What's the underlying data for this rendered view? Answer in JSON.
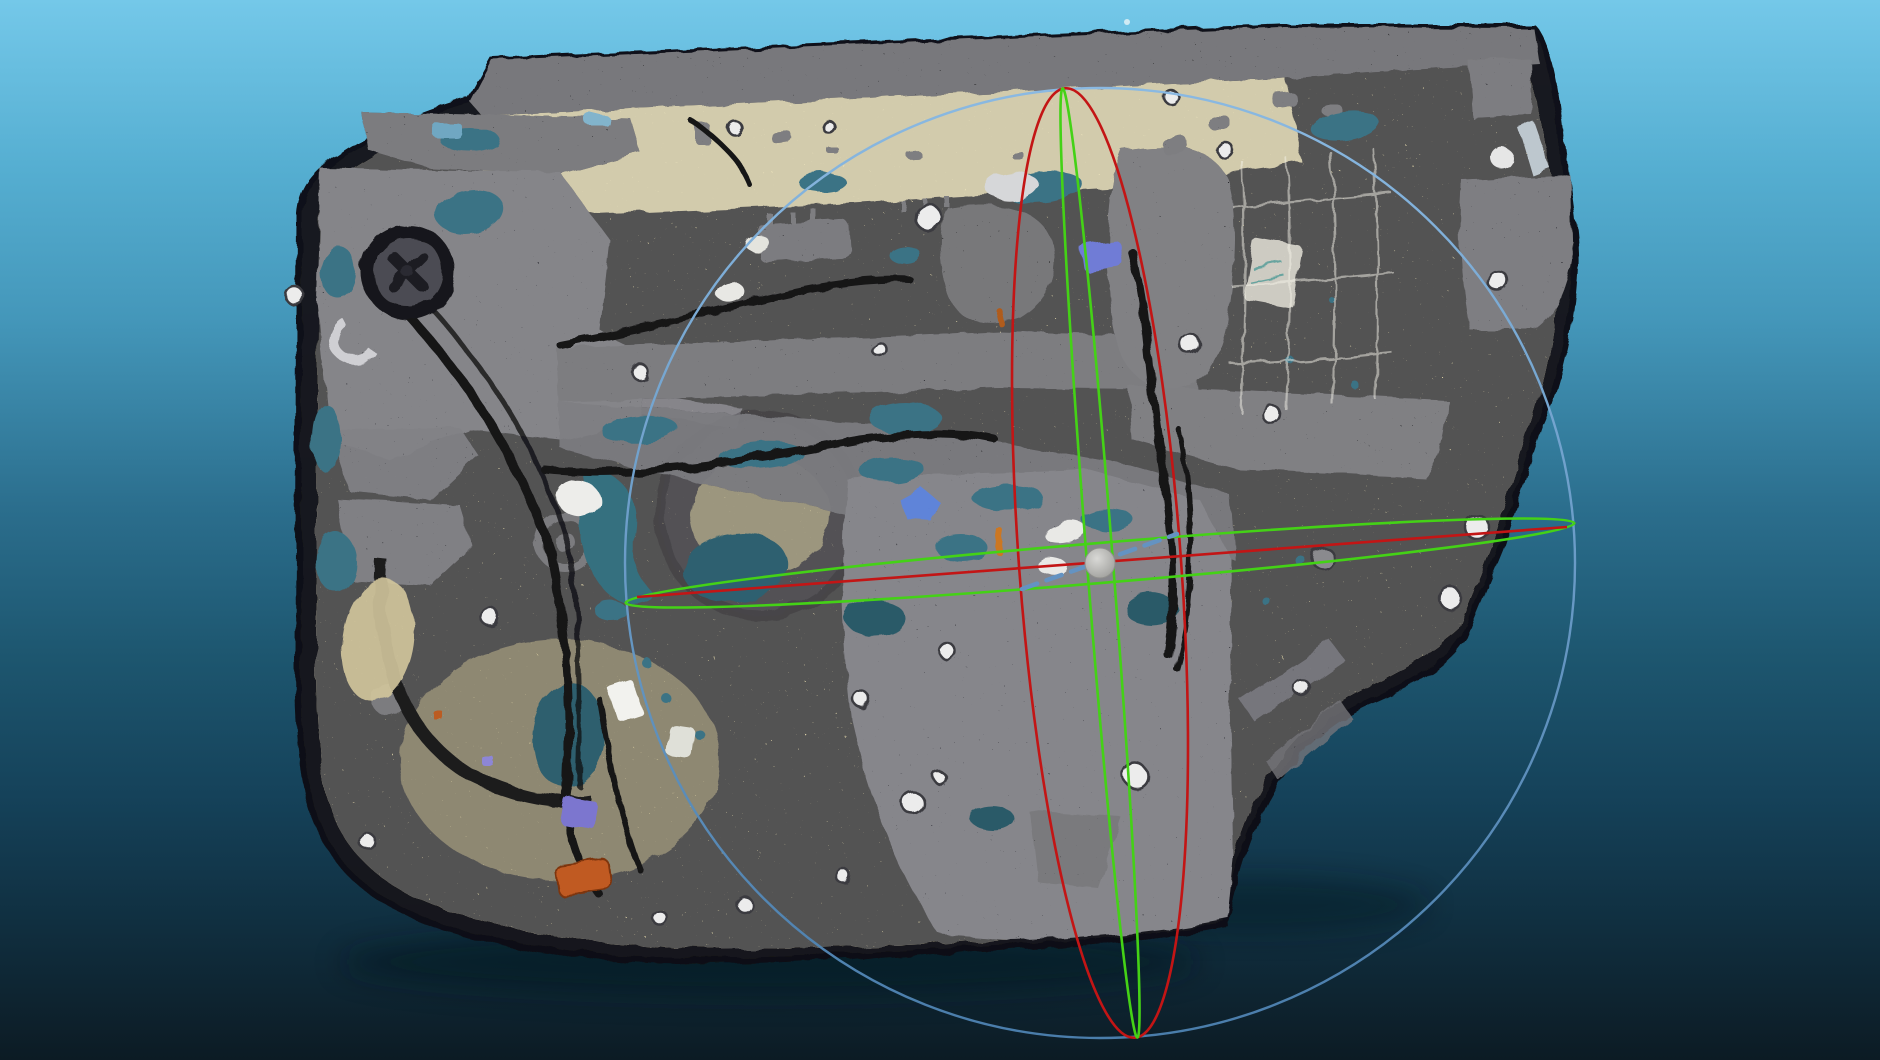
{
  "app": {
    "name": "3d-scan-viewer",
    "view": "point-cloud-viewport",
    "content": "scanned car door inner panel with rotation gizmo"
  },
  "background": {
    "top": "#74c8e9",
    "upper": "#4founds97ba",
    "mid": "#2b6e8d",
    "lower": "#15425a",
    "bottom": "#0c1b24"
  },
  "scan_object": {
    "label": "car-door-inner-panel-scan",
    "panel_tan": "#d7cda4",
    "cream_band": "#e9e0bc",
    "component_black": "#1e1e22",
    "metal_gray": "#2f2f35",
    "hole_teal": "#3a7385",
    "wire_black": "#131315",
    "highlight_white": "#ececec",
    "connector_violet": "#6f7bd6",
    "patch_blue": "#5d84dd",
    "rust_orange": "#c05a22"
  },
  "gizmo": {
    "center_x": 1100,
    "center_y": 563,
    "sphere": {
      "radius": 15,
      "color": "#b9b9b6",
      "edge_color": "#8f8f8c"
    },
    "outer_circle": {
      "r": 475,
      "width": 2.4,
      "color_top": "#8ab9e2",
      "color_bottom": "#4a7dab"
    },
    "red_ring": {
      "rx": 81,
      "ry": 476,
      "rotation": -4.2,
      "color": "#c31515",
      "width": 2.6
    },
    "green_ring_vertical": {
      "rx": 13,
      "ry": 476,
      "rotation": -4.5,
      "color": "#44d216",
      "width": 2.6
    },
    "green_ring_horizontal": {
      "rx": 476,
      "ry": 20,
      "rotation": -4.8,
      "color": "#44d216",
      "width": 2.6
    },
    "red_axis": {
      "x1": 637,
      "y1": 597,
      "x2": 1567,
      "y2": 527,
      "width": 2.6,
      "color": "#c31515"
    },
    "blue_axis": {
      "x1": 1022,
      "y1": 589,
      "x2": 1177,
      "y2": 534,
      "width": 4.5,
      "color": "#6493c2",
      "dash": "16 10"
    }
  }
}
